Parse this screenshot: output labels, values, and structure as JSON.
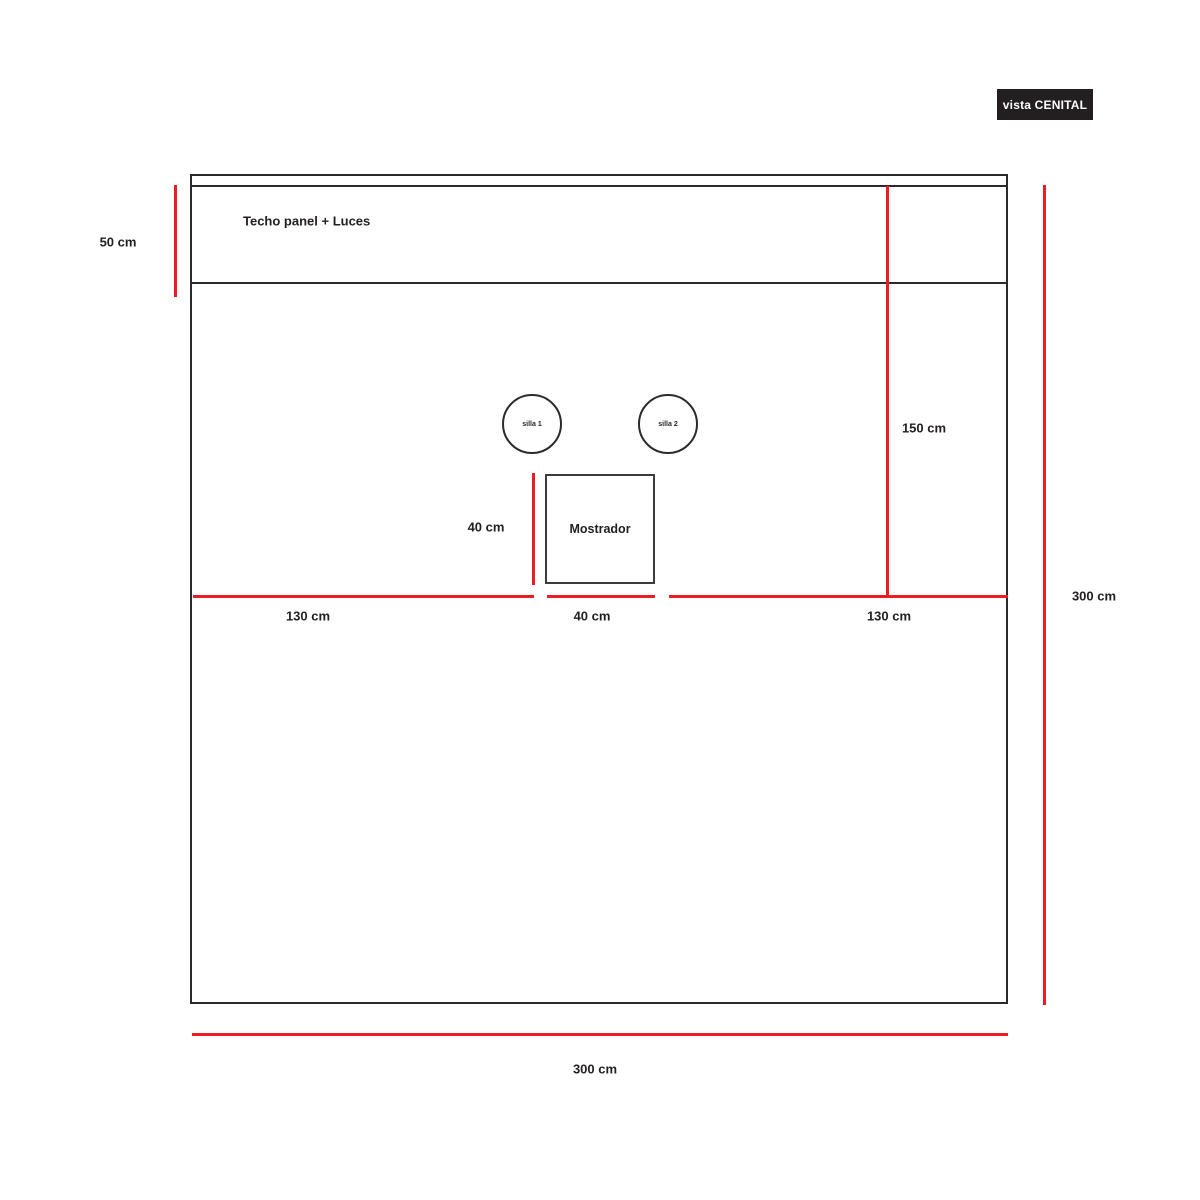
{
  "view_badge": {
    "label": "vista CENITAL"
  },
  "colors": {
    "dimension_red": "#ed1c24",
    "line_dark": "#2d2a2b",
    "badge_bg": "#231f20",
    "badge_fg": "#ffffff",
    "background": "#ffffff"
  },
  "plan": {
    "ceiling": {
      "label": "Techo panel + Luces"
    },
    "chairs": [
      {
        "label": "silla 1"
      },
      {
        "label": "silla 2"
      }
    ],
    "counter": {
      "label": "Mostrador"
    }
  },
  "dimensions": {
    "ceiling_depth": "50 cm",
    "right_upper": "150 cm",
    "right_total": "300 cm",
    "counter_side": "40 cm",
    "bottom_left": "130 cm",
    "bottom_center": "40 cm",
    "bottom_right": "130 cm",
    "bottom_total": "300 cm"
  }
}
